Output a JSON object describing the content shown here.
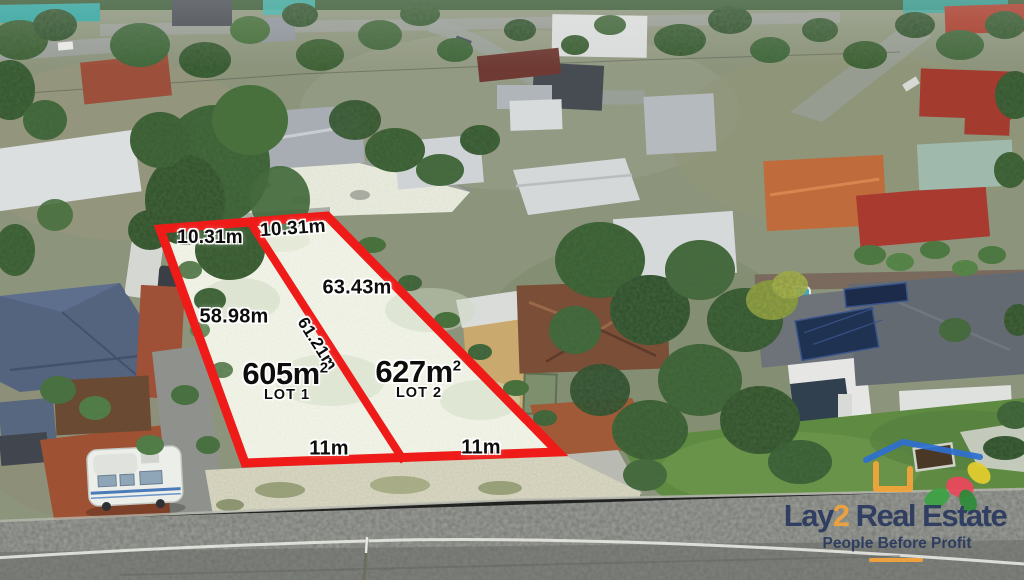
{
  "annotation": {
    "boundary_color": "#ee1b18",
    "label_text_color": "#0d0d0d",
    "label_halo_color": "#ffffff",
    "measurements": {
      "lot1_top": "10.31m",
      "lot2_top": "10.31m",
      "lot2_side": "63.43m",
      "lot1_side": "58.98m",
      "divider": "61.21m",
      "lot1_rear": "11m",
      "lot2_rear": "11m"
    },
    "lots": [
      {
        "area_value": "605m",
        "area_exponent": "2",
        "name": "LOT 1"
      },
      {
        "area_value": "627m",
        "area_exponent": "2",
        "name": "LOT 2"
      }
    ]
  },
  "branding": {
    "logo_part_lay": "Lay",
    "logo_part_2": "2",
    "logo_part_rest": " Real Estate",
    "tagline": "People Before Profit",
    "navy_color": "#2b3a5f",
    "orange_color": "#f2a33c",
    "roof_blue_color": "#2e6fd0",
    "icons": [
      "house-roof-icon",
      "flower-icon"
    ]
  }
}
